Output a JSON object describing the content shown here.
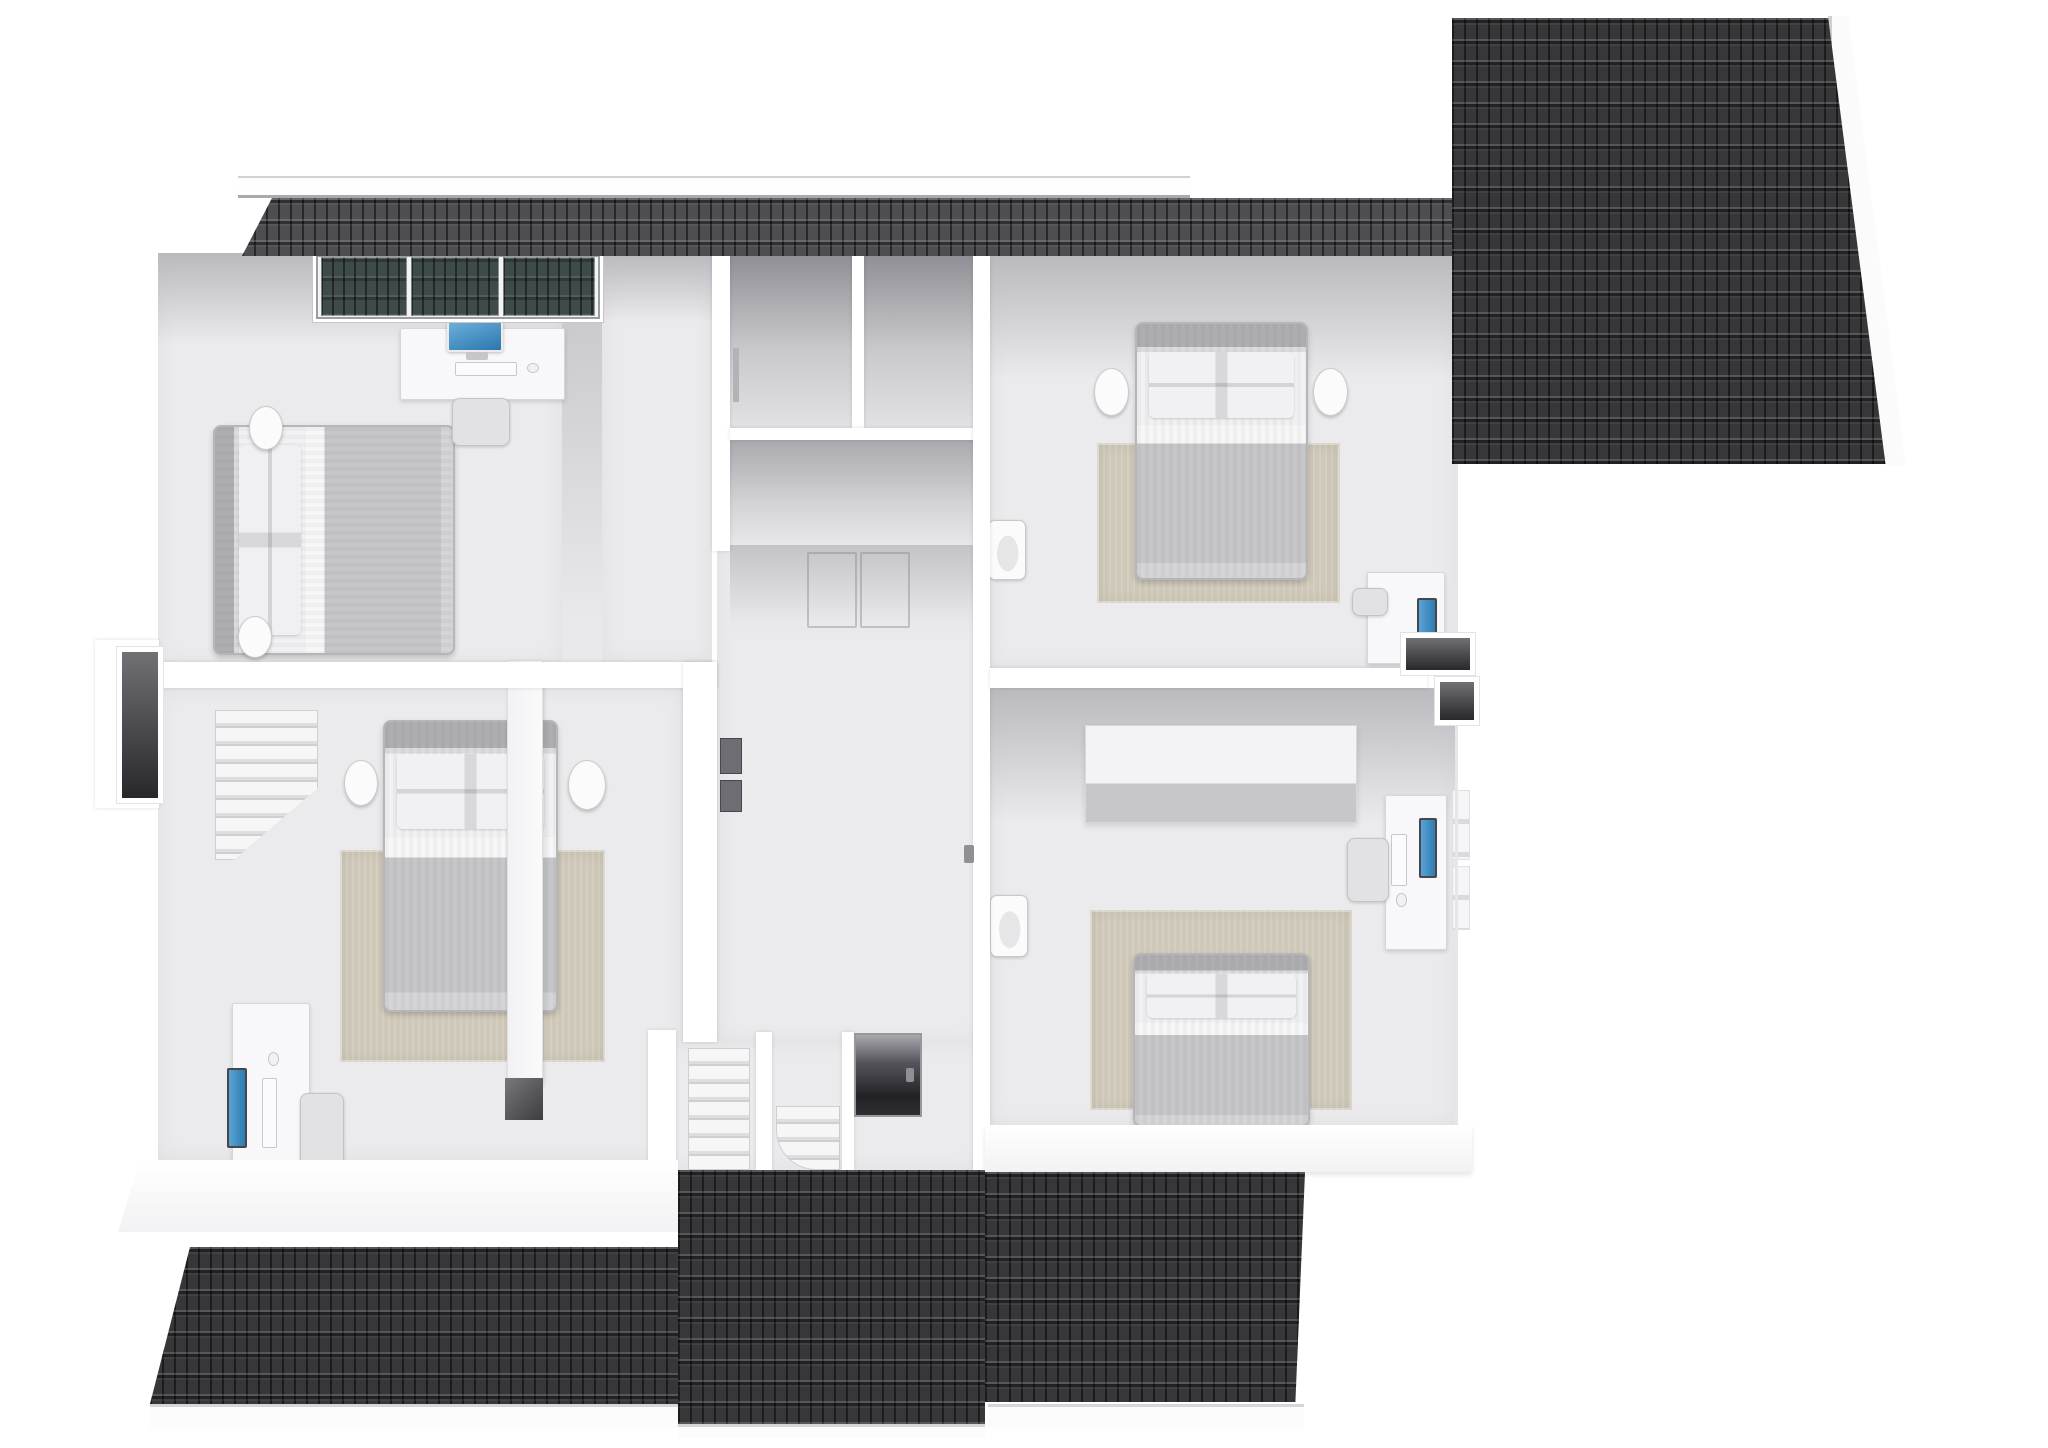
{
  "scene": {
    "type": "3d-floor-plan-render",
    "view": "top-down dollhouse cutaway of an upper storey",
    "width": 2048,
    "height": 1448
  },
  "palette": {
    "floor": "#ebebed",
    "wall": "#ffffff",
    "slope": "#b9b9be",
    "closet": "#8f8f95",
    "roof": "#37373a",
    "roof_strip": "#4e4e52",
    "skylight_glass": "#3e4b4a",
    "rug": "#cfc8b8",
    "duvet": "#c6c6c9",
    "headboard": "#aeaeb2",
    "screen": "#3b8cc4",
    "niche": "#28282c"
  },
  "rooms": [
    {
      "id": "bedroom-top-left",
      "furniture": [
        "double-bed",
        "round-nightstand x2",
        "desk",
        "desktop-computer",
        "keyboard",
        "mouse",
        "chair",
        "skylight-window-3-panes"
      ]
    },
    {
      "id": "bedroom-bottom-left",
      "furniture": [
        "double-bed",
        "round-nightstand x2",
        "area-rug",
        "staircase",
        "desk",
        "monitor",
        "keyboard",
        "mouse",
        "chair",
        "sideboard"
      ]
    },
    {
      "id": "hall-landing",
      "furniture": [
        "corridor",
        "closet x3",
        "sliding-doors",
        "wall-frames",
        "main-staircase",
        "winder-steps",
        "dark-doorway"
      ]
    },
    {
      "id": "bedroom-top-right",
      "furniture": [
        "double-bed",
        "round-nightstand x2",
        "area-rug",
        "wall-sink",
        "desk",
        "monitor",
        "chair"
      ]
    },
    {
      "id": "bedroom-bottom-right",
      "furniture": [
        "double-bed",
        "area-rug",
        "wall-sink",
        "wardrobe-dresser",
        "desk",
        "monitor",
        "keyboard",
        "mouse",
        "chair",
        "window-strips"
      ]
    }
  ],
  "roof_sections": [
    "top-eave-strip",
    "right-gable-roof",
    "bottom-eave-left",
    "bottom-eave-center",
    "bottom-eave-right",
    "ridge-fascia-bars"
  ],
  "elements": [
    {
      "name": "floor-bedroom-top-left",
      "kind": "floor",
      "rect": [
        158,
        253,
        404,
        412
      ]
    },
    {
      "name": "ceiling-slope-top-left",
      "kind": "slope",
      "rect": [
        158,
        253,
        404,
        92
      ]
    },
    {
      "name": "wallface-top-left-right-wall",
      "kind": "wallface",
      "rect": [
        562,
        253,
        40,
        409
      ]
    },
    {
      "name": "floor-corridor",
      "kind": "floor",
      "rect": [
        602,
        253,
        110,
        409
      ]
    },
    {
      "name": "ceiling-slope-corridor",
      "kind": "slope",
      "rect": [
        602,
        253,
        110,
        70
      ]
    },
    {
      "name": "floor-hall",
      "kind": "floor",
      "rect": [
        717,
        545,
        268,
        497
      ]
    },
    {
      "name": "closet-a-interior",
      "kind": "closet",
      "rect": [
        730,
        255,
        122,
        173
      ]
    },
    {
      "name": "closet-b-interior",
      "kind": "closet",
      "rect": [
        864,
        255,
        114,
        173
      ]
    },
    {
      "name": "closet-c-interior",
      "kind": "closet2",
      "rect": [
        730,
        440,
        248,
        105
      ]
    },
    {
      "name": "closet-c-front-wallface",
      "kind": "wallface",
      "rect": [
        730,
        545,
        248,
        88
      ]
    },
    {
      "name": "floor-bedroom-bottom-left",
      "kind": "floor",
      "rect": [
        158,
        688,
        525,
        472
      ]
    },
    {
      "name": "floor-stair-bay",
      "kind": "floor",
      "rect": [
        648,
        1042,
        337,
        128
      ]
    },
    {
      "name": "floor-bedroom-top-right",
      "kind": "floor",
      "rect": [
        990,
        255,
        465,
        413
      ]
    },
    {
      "name": "ceiling-slope-top-right",
      "kind": "slope",
      "rect": [
        990,
        255,
        465,
        125
      ]
    },
    {
      "name": "floor-bedroom-bottom-right",
      "kind": "floor",
      "rect": [
        990,
        688,
        465,
        437
      ]
    },
    {
      "name": "ceiling-slope-bottom-right",
      "kind": "slope",
      "rect": [
        990,
        688,
        465,
        135
      ]
    },
    {
      "name": "area-rug-bottom-left",
      "kind": "rug",
      "rect": [
        340,
        850,
        265,
        212
      ]
    },
    {
      "name": "area-rug-top-right",
      "kind": "rug",
      "rect": [
        1097,
        443,
        243,
        160
      ]
    },
    {
      "name": "area-rug-bottom-right",
      "kind": "rug",
      "rect": [
        1090,
        910,
        262,
        200
      ]
    },
    {
      "name": "staircase-bedroom-bottom-left",
      "kind": "stairs",
      "rect": [
        215,
        710,
        103,
        150
      ],
      "style": "clip-path:polygon(0 0,100% 0,100% 52%,18% 100%,0 100%);"
    },
    {
      "name": "bed-top-left",
      "kind": "bed-h",
      "rect": [
        213,
        425,
        242,
        230
      ]
    },
    {
      "name": "nightstand-top-left-upper",
      "kind": "nightstand",
      "rect": [
        249,
        406,
        34,
        44
      ]
    },
    {
      "name": "nightstand-top-left-lower",
      "kind": "nightstand",
      "rect": [
        238,
        616,
        34,
        42
      ]
    },
    {
      "name": "desk-top-left",
      "kind": "desk",
      "rect": [
        400,
        328,
        165,
        72
      ]
    },
    {
      "name": "imac-screen",
      "kind": "imac",
      "rect": [
        447,
        320,
        56,
        32
      ]
    },
    {
      "name": "imac-stand",
      "kind": "stand",
      "rect": [
        466,
        352,
        22,
        8
      ]
    },
    {
      "name": "keyboard-top-left",
      "kind": "keyboard",
      "rect": [
        455,
        362,
        62,
        14
      ]
    },
    {
      "name": "mouse-top-left",
      "kind": "mouse",
      "rect": [
        527,
        363,
        12,
        10
      ]
    },
    {
      "name": "chair-top-left",
      "kind": "chair",
      "rect": [
        452,
        398,
        58,
        48
      ]
    },
    {
      "name": "bed-bottom-left",
      "kind": "bed-v",
      "rect": [
        383,
        720,
        175,
        292
      ]
    },
    {
      "name": "nightstand-bottom-left-left",
      "kind": "nightstand",
      "rect": [
        344,
        760,
        34,
        46
      ]
    },
    {
      "name": "nightstand-bottom-left-right",
      "kind": "nightstand",
      "rect": [
        568,
        760,
        38,
        50
      ]
    },
    {
      "name": "sideboard-bottom-left",
      "kind": "cabinet",
      "rect": [
        507,
        660,
        36,
        424
      ]
    },
    {
      "name": "sideboard-dark-end",
      "kind": "shelf-dark",
      "rect": [
        505,
        1078,
        38,
        42
      ]
    },
    {
      "name": "desk-bottom-left",
      "kind": "desk",
      "rect": [
        232,
        1003,
        78,
        182
      ]
    },
    {
      "name": "monitor-bottom-left",
      "kind": "monitor-v",
      "rect": [
        227,
        1068,
        20,
        80
      ]
    },
    {
      "name": "keyboard-bottom-left",
      "kind": "keyboard",
      "rect": [
        262,
        1078,
        15,
        70
      ]
    },
    {
      "name": "mouse-bottom-left",
      "kind": "mouse",
      "rect": [
        268,
        1052,
        11,
        14
      ]
    },
    {
      "name": "chair-bottom-left",
      "kind": "chair",
      "rect": [
        300,
        1093,
        44,
        82
      ]
    },
    {
      "name": "bed-top-right",
      "kind": "bed-v",
      "rect": [
        1135,
        322,
        173,
        258
      ]
    },
    {
      "name": "nightstand-top-right-left",
      "kind": "nightstand",
      "rect": [
        1094,
        368,
        35,
        48
      ]
    },
    {
      "name": "nightstand-top-right-right",
      "kind": "nightstand",
      "rect": [
        1313,
        368,
        35,
        48
      ]
    },
    {
      "name": "wall-sink-top-right",
      "kind": "sink",
      "rect": [
        988,
        520,
        38,
        60
      ]
    },
    {
      "name": "desk-top-right",
      "kind": "desk",
      "rect": [
        1367,
        572,
        78,
        92
      ]
    },
    {
      "name": "monitor-top-right",
      "kind": "monitor-v",
      "rect": [
        1417,
        598,
        20,
        46
      ]
    },
    {
      "name": "chair-top-right",
      "kind": "chair",
      "rect": [
        1352,
        588,
        36,
        28
      ]
    },
    {
      "name": "dresser-bottom-right",
      "kind": "block3d",
      "rect": [
        1085,
        725,
        272,
        98
      ]
    },
    {
      "name": "wall-sink-bottom-right",
      "kind": "sink",
      "rect": [
        990,
        895,
        38,
        62
      ]
    },
    {
      "name": "bed-bottom-right",
      "kind": "bed-v",
      "rect": [
        1133,
        953,
        177,
        174
      ]
    },
    {
      "name": "desk-bottom-right",
      "kind": "desk",
      "rect": [
        1385,
        795,
        62,
        155
      ]
    },
    {
      "name": "monitor-bottom-right",
      "kind": "monitor-v",
      "rect": [
        1419,
        818,
        18,
        60
      ]
    },
    {
      "name": "keyboard-bottom-right",
      "kind": "keyboard",
      "rect": [
        1391,
        834,
        16,
        52
      ]
    },
    {
      "name": "mouse-bottom-right",
      "kind": "mouse",
      "rect": [
        1396,
        893,
        11,
        14
      ]
    },
    {
      "name": "chair-bottom-right",
      "kind": "chair",
      "rect": [
        1347,
        838,
        42,
        64
      ]
    },
    {
      "name": "window-strip-right-1",
      "kind": "window-strip",
      "rect": [
        1452,
        790,
        18,
        70
      ]
    },
    {
      "name": "window-strip-right-2",
      "kind": "window-strip",
      "rect": [
        1452,
        866,
        18,
        64
      ]
    },
    {
      "name": "wall-corridor-closets",
      "kind": "wall",
      "rect": [
        712,
        238,
        18,
        313
      ]
    },
    {
      "name": "wall-closet-divider",
      "kind": "wall",
      "rect": [
        852,
        255,
        12,
        173
      ]
    },
    {
      "name": "wall-below-closets",
      "kind": "wall",
      "rect": [
        730,
        428,
        248,
        12
      ]
    },
    {
      "name": "wall-between-left-bedrooms",
      "kind": "wall",
      "rect": [
        158,
        662,
        559,
        26
      ]
    },
    {
      "name": "wall-bottom-left-room-right",
      "kind": "wall",
      "rect": [
        683,
        662,
        34,
        380
      ]
    },
    {
      "name": "wall-hall-right",
      "kind": "wall",
      "rect": [
        973,
        238,
        17,
        932
      ]
    },
    {
      "name": "door-handle-hall",
      "kind": "handle",
      "rect": [
        964,
        845,
        10,
        18
      ]
    },
    {
      "name": "wall-frame-hall-1",
      "kind": "frame",
      "rect": [
        720,
        738,
        22,
        36
      ]
    },
    {
      "name": "wall-frame-hall-2",
      "kind": "frame",
      "rect": [
        720,
        780,
        22,
        32
      ]
    },
    {
      "name": "closet-door-hinge",
      "kind": "hinge",
      "rect": [
        733,
        348,
        6,
        54
      ]
    },
    {
      "name": "wall-between-right-bedrooms",
      "kind": "wall",
      "rect": [
        990,
        668,
        437,
        20
      ]
    },
    {
      "name": "sliding-door-outline-1",
      "kind": "door-outline",
      "rect": [
        807,
        552,
        50,
        76
      ]
    },
    {
      "name": "sliding-door-outline-2",
      "kind": "door-outline",
      "rect": [
        860,
        552,
        50,
        76
      ]
    },
    {
      "name": "wall-stair-left",
      "kind": "wall",
      "rect": [
        648,
        1030,
        28,
        140
      ]
    },
    {
      "name": "main-staircase",
      "kind": "stairs",
      "rect": [
        688,
        1048,
        62,
        122
      ]
    },
    {
      "name": "stair-rail-wall",
      "kind": "wall",
      "rect": [
        756,
        1032,
        16,
        138
      ]
    },
    {
      "name": "winder-steps",
      "kind": "stairs",
      "rect": [
        776,
        1106,
        64,
        64
      ],
      "style": "border-radius:0 0 0 40px;"
    },
    {
      "name": "wall-stair-mid",
      "kind": "wall",
      "rect": [
        842,
        1032,
        12,
        138
      ]
    },
    {
      "name": "stairwell-dark-doorway",
      "kind": "doorway",
      "rect": [
        854,
        1033,
        68,
        84
      ]
    },
    {
      "name": "doorway-handle",
      "kind": "handle",
      "rect": [
        906,
        1068,
        8,
        14
      ]
    },
    {
      "name": "exterior-wallface-bottom-left",
      "kind": "wallext",
      "rect": [
        118,
        1160,
        560,
        72
      ],
      "style": "clip-path:polygon(22px 0,100% 0,100% 100%,0 100%);"
    },
    {
      "name": "exterior-wallface-bottom-right",
      "kind": "wallext",
      "rect": [
        985,
        1125,
        487,
        47
      ]
    },
    {
      "name": "chimney-bump-left",
      "kind": "wall",
      "rect": [
        95,
        640,
        64,
        168
      ]
    },
    {
      "name": "chimney-niche-left",
      "kind": "niche",
      "rect": [
        122,
        652,
        36,
        146
      ]
    },
    {
      "name": "exterior-right-wall-edge",
      "kind": "edge",
      "rect": [
        1455,
        255,
        3,
        870
      ]
    },
    {
      "name": "skylight-frame",
      "kind": "skyframe",
      "rect": [
        313,
        252,
        290,
        70
      ]
    },
    {
      "name": "skylight-glass-1",
      "kind": "glass",
      "rect": [
        321,
        257,
        86,
        59
      ]
    },
    {
      "name": "skylight-glass-2",
      "kind": "glass",
      "rect": [
        411,
        257,
        88,
        59
      ]
    },
    {
      "name": "skylight-glass-3",
      "kind": "glass",
      "rect": [
        503,
        257,
        92,
        59
      ]
    },
    {
      "name": "ridge-fascia-top",
      "kind": "ridge",
      "rect": [
        238,
        176,
        952,
        22
      ]
    },
    {
      "name": "roof-top-eave-strip",
      "kind": "roof roof-strip",
      "rect": [
        242,
        198,
        1210,
        58
      ],
      "style": "clip-path:polygon(0 100%,30px 0,100% 0,100% 100%);"
    },
    {
      "name": "roof-right-gable",
      "kind": "roof",
      "rect": [
        1452,
        18,
        440,
        446
      ],
      "style": "clip-path:polygon(0 0,86% 0,100% 100%,0 100%);"
    },
    {
      "name": "fascia-right-gable",
      "kind": "fascia-slant",
      "rect": [
        1828,
        16,
        78,
        450
      ],
      "style": "clip-path:polygon(0 0,26% 0,100% 100%,74% 100%);"
    },
    {
      "name": "roof-bottom-eave-left",
      "kind": "roof",
      "rect": [
        150,
        1247,
        528,
        157
      ],
      "style": "clip-path:polygon(0 100%,40px 0,100% 0,100% 100%);"
    },
    {
      "name": "roof-bottom-eave-center",
      "kind": "roof",
      "rect": [
        678,
        1170,
        307,
        254
      ]
    },
    {
      "name": "roof-bottom-eave-right",
      "kind": "roof",
      "rect": [
        985,
        1172,
        320,
        230
      ],
      "style": "clip-path:polygon(0 0,100% 0,97% 100%,0 100%);"
    },
    {
      "name": "fascia-bottom-left",
      "kind": "fascia",
      "rect": [
        150,
        1404,
        528,
        24
      ]
    },
    {
      "name": "fascia-bottom-center",
      "kind": "fascia",
      "rect": [
        678,
        1424,
        307,
        14
      ]
    },
    {
      "name": "fascia-bottom-right",
      "kind": "fascia",
      "rect": [
        988,
        1404,
        316,
        24
      ]
    },
    {
      "name": "chimney-niche-right-1",
      "kind": "niche",
      "rect": [
        1406,
        638,
        64,
        32
      ]
    },
    {
      "name": "chimney-niche-right-2",
      "kind": "niche",
      "rect": [
        1440,
        682,
        34,
        38
      ]
    }
  ]
}
